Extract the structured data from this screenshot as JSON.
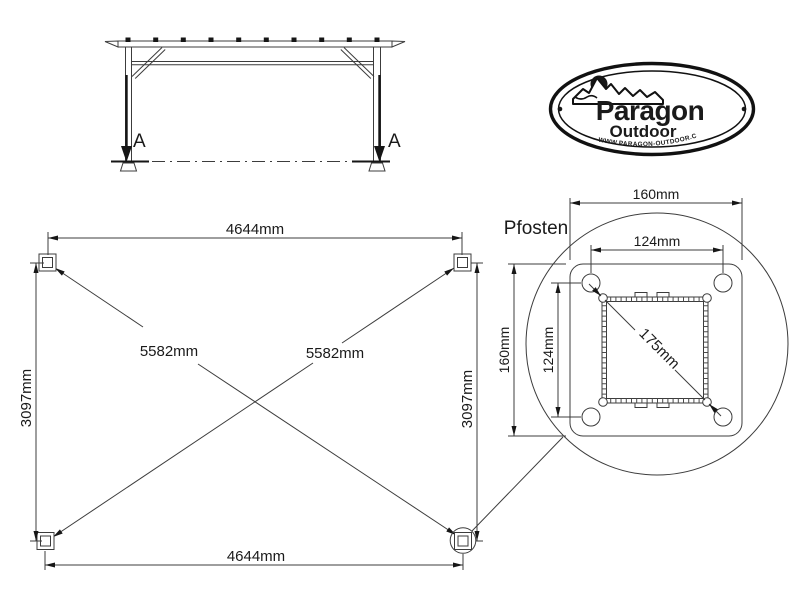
{
  "elevation": {
    "section_label_left": "A",
    "section_label_right": "A"
  },
  "logo": {
    "brand": "Paragon",
    "sub_brand": "Outdoor",
    "website": "WWW.PARAGON-OUTDOOR.COM"
  },
  "plan": {
    "width_top": "4644mm",
    "width_bottom": "4644mm",
    "height_left": "3097mm",
    "height_right": "3097mm",
    "diagonal_left": "5582mm",
    "diagonal_right": "5582mm"
  },
  "detail": {
    "title": "Pfosten",
    "plate_width": "160mm",
    "plate_height": "160mm",
    "hole_spacing_horizontal": "124mm",
    "hole_spacing_vertical": "124mm",
    "post_diagonal": "175mm"
  },
  "colors": {
    "background": "#ffffff",
    "line": "#3c3c3c",
    "text": "#1a1a1a",
    "arrow": "#161616"
  }
}
